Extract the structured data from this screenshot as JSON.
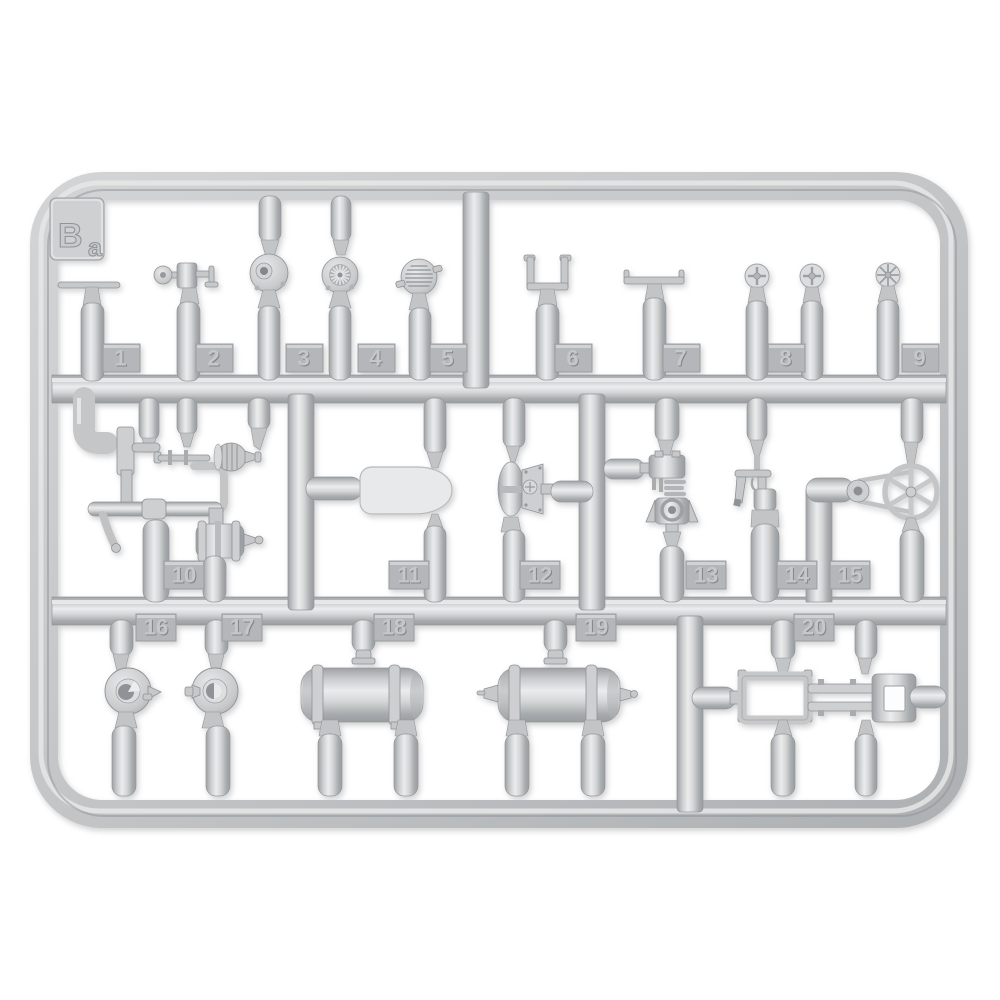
{
  "photo": {
    "subject": "plastic-model-kit-sprue",
    "background_color": "#ffffff",
    "plastic_color": "#c6c8ca",
    "highlight_color": "#eceded",
    "shadow_color": "#9a9da0"
  },
  "sprue": {
    "label": "Ba",
    "label_main": "B",
    "label_sub": "a",
    "parts": [
      {
        "number": "1",
        "name": "t-handle-valve"
      },
      {
        "number": "2",
        "name": "handwheel-valve-assembly"
      },
      {
        "number": "3",
        "name": "round-housing-with-bore"
      },
      {
        "number": "4",
        "name": "ribbed-fan-disc"
      },
      {
        "number": "5",
        "name": "louvered-strainer-disc"
      },
      {
        "number": "6",
        "name": "u-shaped-bracket"
      },
      {
        "number": "7",
        "name": "flat-mount-bracket"
      },
      {
        "number": "8",
        "name": "small-handwheel-pair"
      },
      {
        "number": "9",
        "name": "spoked-handwheel"
      },
      {
        "number": "10",
        "name": "workshop-machine-assembly"
      },
      {
        "number": "11",
        "name": "tractor-seat"
      },
      {
        "number": "12",
        "name": "valve-body-with-flange"
      },
      {
        "number": "13",
        "name": "carburetor-assembly"
      },
      {
        "number": "14",
        "name": "grease-gun"
      },
      {
        "number": "15",
        "name": "belt-pulley-with-drive-belt"
      },
      {
        "number": "16",
        "name": "wheel-hub-open"
      },
      {
        "number": "17",
        "name": "wheel-hub-capped"
      },
      {
        "number": "18",
        "name": "cylindrical-tank"
      },
      {
        "number": "19",
        "name": "cylindrical-tank-with-tap"
      },
      {
        "number": "20",
        "name": "chassis-frame"
      }
    ]
  }
}
